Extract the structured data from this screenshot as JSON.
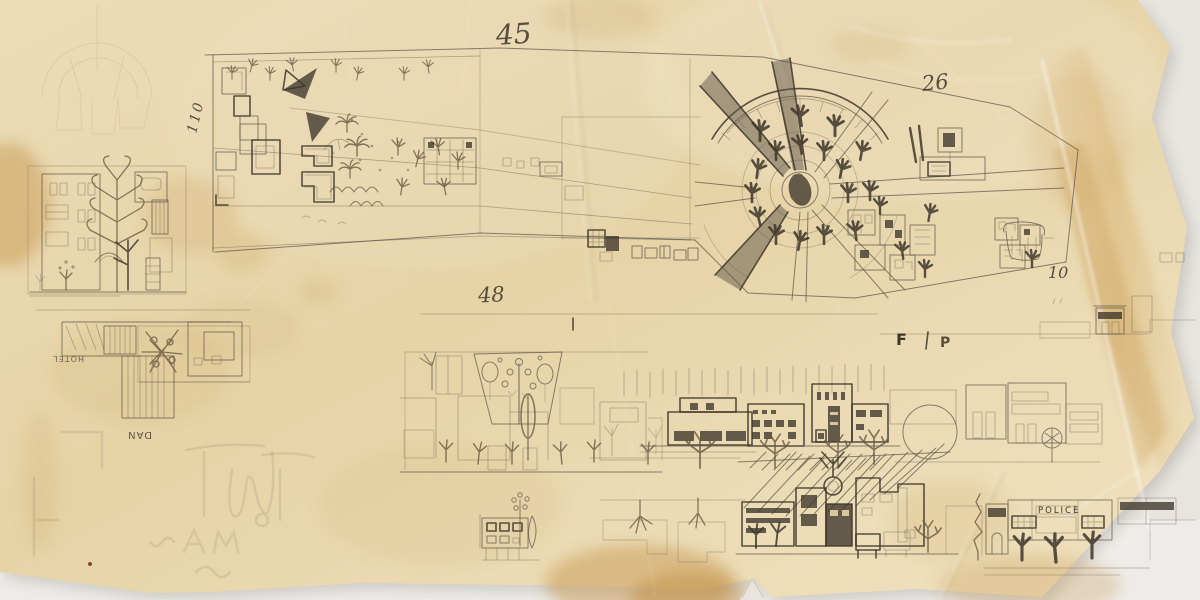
{
  "scene": {
    "type": "photograph of a hand-drawn architectural concept sketch",
    "description": "Pencil sketch on crumpled, stained tracing paper: a long boulevard plan ending in a radial plaza with radiating streets, plus street-elevation studies of buildings and trees below",
    "paper": "yellowed tracing paper with creases, amber stains, a vertical fold at right and torn edges"
  },
  "labels": {
    "n45": "45",
    "n26": "26",
    "n48": "48",
    "n10": "10",
    "n110": "110",
    "hotel": "HOTEL",
    "dan": "DAN",
    "police": "POLICE",
    "f": "F",
    "p": "P"
  },
  "colors": {
    "backdrop": "#e8e5e0",
    "paper1": "#ecdcb6",
    "paper2": "#e6d3a6",
    "paper3": "#efe1bd",
    "stain": "#c89a52",
    "stain2": "#bd8a3e",
    "fold": "#d8b474",
    "graphite": "#5f5547",
    "graphitedark": "#3e362b",
    "sepia": "#6a5a41"
  }
}
